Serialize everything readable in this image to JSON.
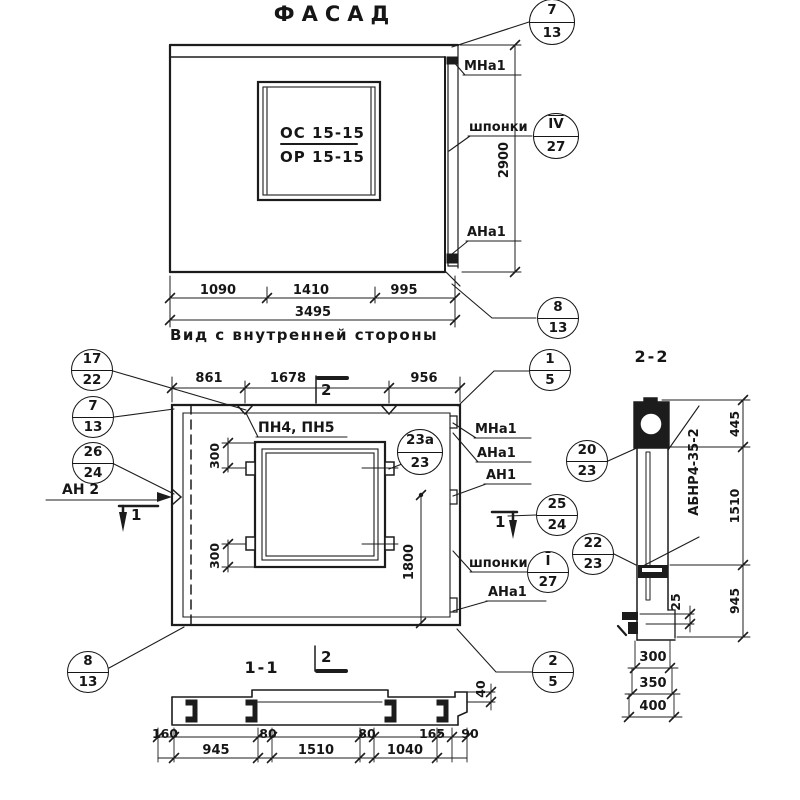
{
  "facade": {
    "title": "ФАСАД",
    "panel_mark_top": "ОС 15-15",
    "panel_mark_bottom": "ОР 15-15",
    "label_mna1": "МНа1",
    "label_shponki": "шпонки",
    "label_ana1": "АНа1",
    "dim_height": "2900",
    "dim_1": "1090",
    "dim_2": "1410",
    "dim_3": "995",
    "dim_total": "3495",
    "callout_top": {
      "top": "7",
      "bottom": "13"
    },
    "callout_shponki": {
      "top": "IV",
      "bottom": "27"
    },
    "callout_bottom": {
      "top": "8",
      "bottom": "13"
    }
  },
  "inner_view": {
    "title": "Вид с внутренней стороны",
    "dim_1": "861",
    "dim_2": "1678",
    "dim_3": "956",
    "label_pn": "ПН4, ПН5",
    "label_an2": "АН 2",
    "label_mna1": "МНа1",
    "label_ana1_top": "АНа1",
    "label_an1": "АН1",
    "label_shponki": "шпонки",
    "label_ana1_bottom": "АНа1",
    "dim_300_top": "300",
    "dim_300_bottom": "300",
    "dim_1800": "1800",
    "section_marker_1": "1",
    "section_marker_2": "2",
    "callouts": {
      "c17_22": {
        "top": "17",
        "bottom": "22"
      },
      "c7_13": {
        "top": "7",
        "bottom": "13"
      },
      "c26_24": {
        "top": "26",
        "bottom": "24"
      },
      "c1_5": {
        "top": "1",
        "bottom": "5"
      },
      "c23a_23": {
        "top": "23а",
        "bottom": "23"
      },
      "c20_23": {
        "top": "20",
        "bottom": "23"
      },
      "c25_24": {
        "top": "25",
        "bottom": "24"
      },
      "c22_23": {
        "top": "22",
        "bottom": "23"
      },
      "c_shponki": {
        "top": "I",
        "bottom": "27"
      },
      "c2_5": {
        "top": "2",
        "bottom": "5"
      },
      "c8_13": {
        "top": "8",
        "bottom": "13"
      }
    }
  },
  "section_1_1": {
    "title": "1-1",
    "marker": "2",
    "dims_row1": [
      "160",
      "80",
      "80",
      "165",
      "90"
    ],
    "dims_row2": [
      "945",
      "1510",
      "1040"
    ],
    "dim_40": "40"
  },
  "section_2_2": {
    "title": "2-2",
    "label_product": "АБНР4-35-2",
    "dim_445": "445",
    "dim_1510": "1510",
    "dim_945": "945",
    "dim_25": "25",
    "dims_bottom": [
      "300",
      "350",
      "400"
    ]
  },
  "colors": {
    "ink": "#161616",
    "paper": "#ffffff"
  }
}
